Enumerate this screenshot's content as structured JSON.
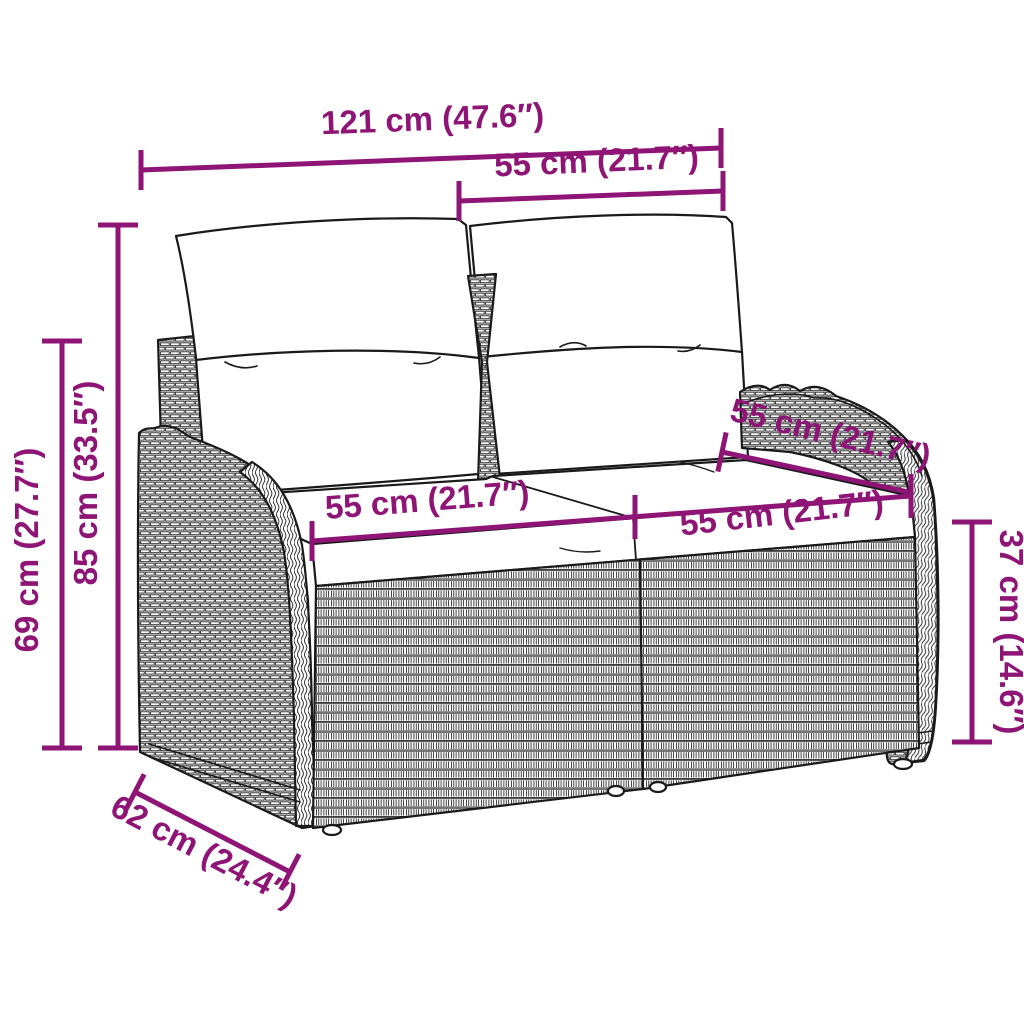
{
  "meta": {
    "type": "product-dimension-diagram",
    "subject": "poly rattan 2-seater garden bench with back pillows and seat cushions"
  },
  "colors": {
    "dimension_accent": "#8E1476",
    "line_art": "#1A1A1A",
    "background": "#FFFFFF"
  },
  "dimensions": {
    "overall_width": {
      "label": "121 cm (47.6″)"
    },
    "backrest_cushion_width": {
      "label": "55 cm (21.7″)"
    },
    "total_height": {
      "label": "85 cm (33.5″)"
    },
    "back_height": {
      "label": "69 cm (27.7″)"
    },
    "seat_width_left": {
      "label": "55 cm (21.7″)"
    },
    "seat_width_right": {
      "label": "55 cm (21.7″)"
    },
    "seat_depth": {
      "label": "55 cm (21.7″)"
    },
    "side_depth": {
      "label": "62 cm (24.4″)"
    },
    "seat_height": {
      "label": "37 cm (14.6″)"
    }
  }
}
